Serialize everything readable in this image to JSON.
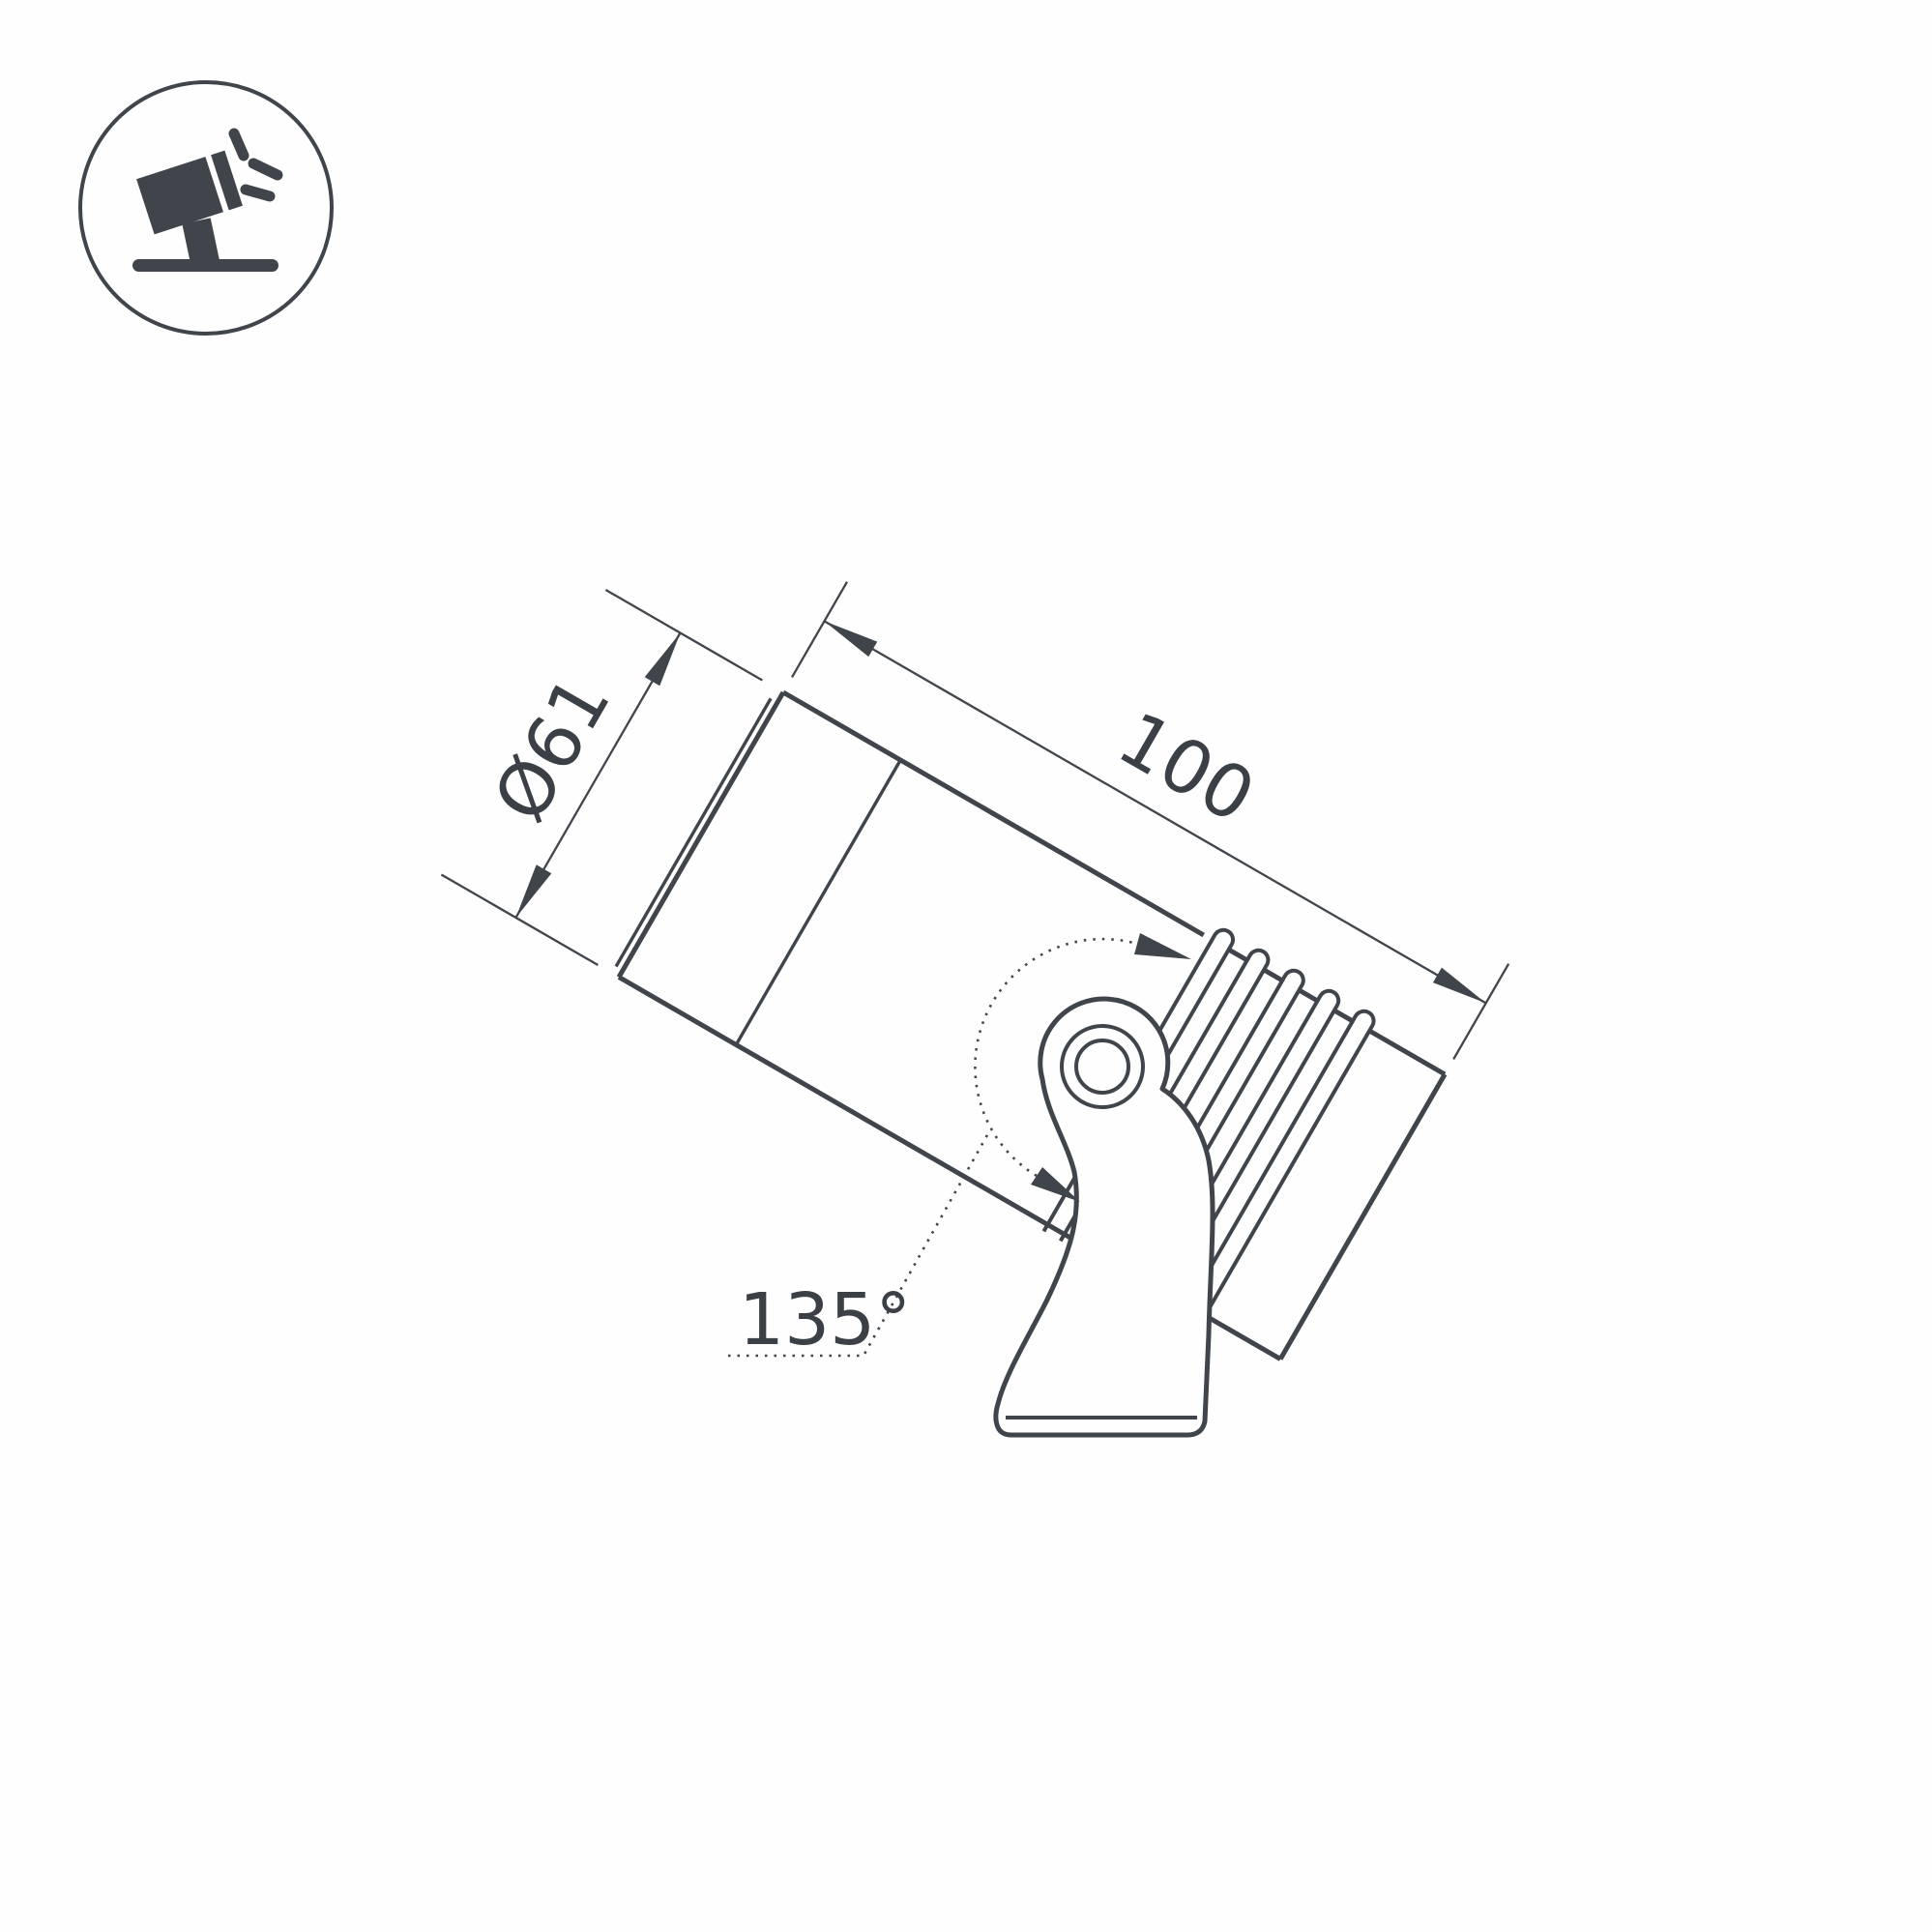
{
  "page": {
    "background": "#ffffff"
  },
  "drawing": {
    "line_color": "#40454b",
    "icon": {
      "name": "tilted-spotlight-icon"
    },
    "labels": {
      "diameter": "Ø61",
      "length": "100",
      "rotation_angle": "135°"
    }
  }
}
